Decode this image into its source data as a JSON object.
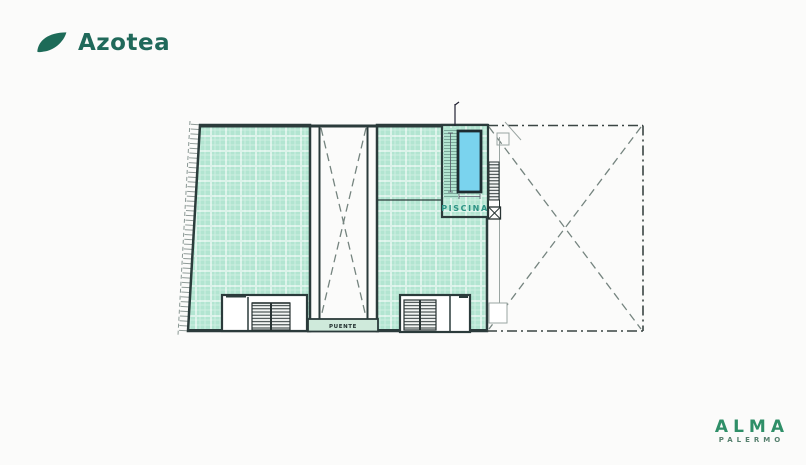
{
  "header": {
    "brand": "Azotea"
  },
  "plan": {
    "labels": {
      "piscina": "PISCINA",
      "puente": "PUENTE"
    },
    "colors": {
      "mint": "#b2e5d1",
      "pool_blue": "#7ad3ee",
      "line_dark": "#2b3b3b",
      "teal_text": "#2e9385",
      "logo_teal": "#1d6b58",
      "logo_green": "#2f8f68"
    }
  },
  "footer": {
    "brand": "ALMA",
    "sub_brand": "PALERMO"
  }
}
